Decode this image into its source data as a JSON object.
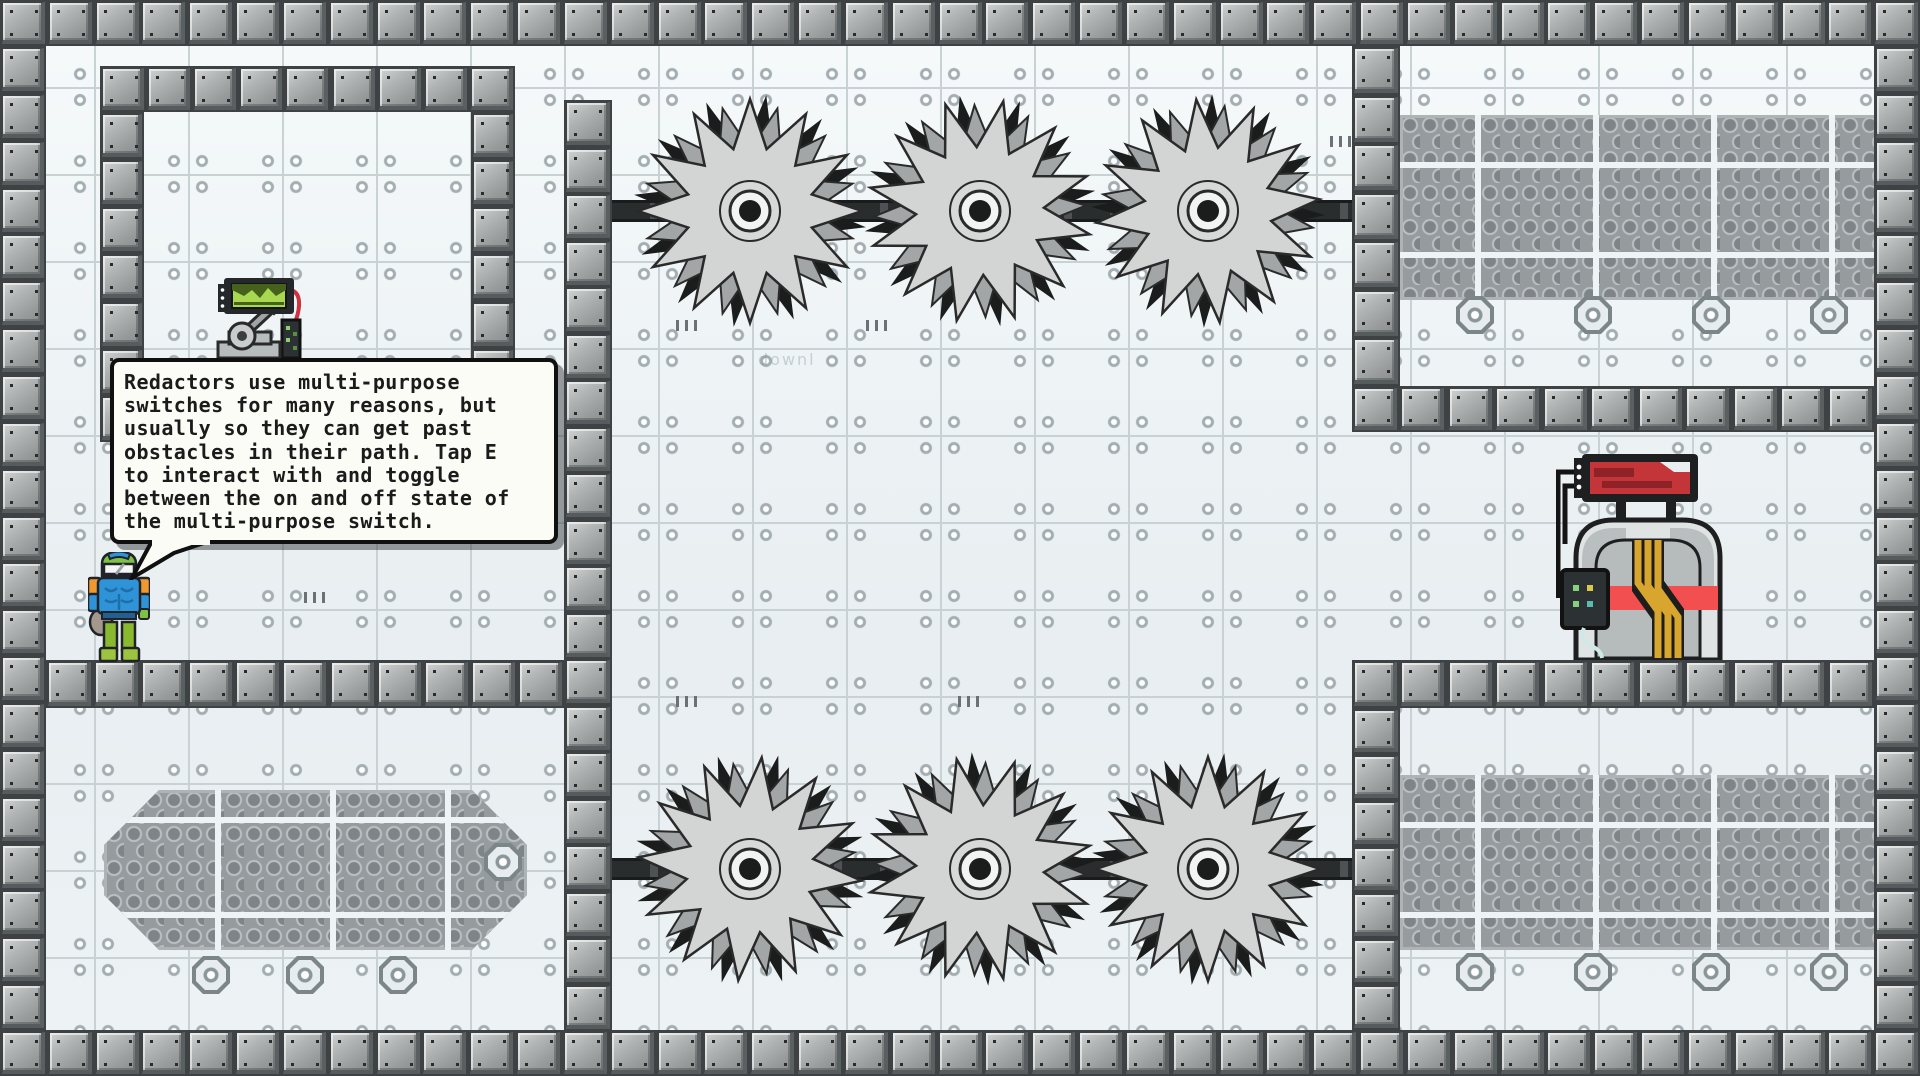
{
  "bubble": {
    "text": "Redactors use multi-purpose\nswitches for many reasons, but\nusually so they can get past\nobstacles in their path. Tap E\nto interact with and toggle\nbetween the on and off state of\nthe multi-purpose switch.",
    "interact_key": "E"
  },
  "watermark_text": "downl",
  "entities": {
    "player": "redactor-robot",
    "switch": "multi-purpose-switch",
    "machine": "wired-console",
    "hazard": "spinning-saw-blade",
    "saw_count": 6
  },
  "colors": {
    "tile": "#edf2f4",
    "tile_line": "#c8d2d5",
    "block": "#a9adad",
    "block_gap": "#3f4244",
    "hex_bg": "#969b9e",
    "saw_light": "#d2d5d4",
    "saw_mid": "#a2a6a6",
    "saw_dark": "#1b1d1d",
    "bubble_bg": "#fcfcf6",
    "bubble_border": "#101010",
    "accent_red": "#e8474b",
    "accent_yellow": "#d8a52e",
    "accent_green": "#a8d84f",
    "player_blue": "#2f93d8",
    "player_green": "#7dc242",
    "player_orange": "#f0992e"
  },
  "level": {
    "walls": [
      {
        "x": 0,
        "y": 0,
        "w": 1920,
        "h": 46
      },
      {
        "x": 0,
        "y": 1030,
        "w": 1920,
        "h": 46
      },
      {
        "x": 0,
        "y": 46,
        "w": 46,
        "h": 984
      },
      {
        "x": 1874,
        "y": 46,
        "w": 46,
        "h": 984
      },
      {
        "x": 100,
        "y": 66,
        "w": 415,
        "h": 46
      },
      {
        "x": 100,
        "y": 112,
        "w": 44,
        "h": 330
      },
      {
        "x": 471,
        "y": 112,
        "w": 44,
        "h": 330
      },
      {
        "x": 564,
        "y": 100,
        "w": 48,
        "h": 930
      },
      {
        "x": 46,
        "y": 660,
        "w": 518,
        "h": 48
      },
      {
        "x": 1352,
        "y": 46,
        "w": 48,
        "h": 340
      },
      {
        "x": 1352,
        "y": 386,
        "w": 522,
        "h": 46
      },
      {
        "x": 1352,
        "y": 660,
        "w": 522,
        "h": 48
      },
      {
        "x": 1352,
        "y": 708,
        "w": 48,
        "h": 322
      }
    ],
    "rails": [
      {
        "x": 612,
        "y": 200,
        "w": 740,
        "h": 22
      },
      {
        "x": 612,
        "y": 858,
        "w": 740,
        "h": 22
      }
    ],
    "saws": [
      {
        "cx": 750,
        "cy": 211,
        "rot": 0
      },
      {
        "cx": 980,
        "cy": 211,
        "rot": 12
      },
      {
        "cx": 1208,
        "cy": 211,
        "rot": 24
      },
      {
        "cx": 750,
        "cy": 869,
        "rot": 6
      },
      {
        "cx": 980,
        "cy": 869,
        "rot": 18
      },
      {
        "cx": 1208,
        "cy": 869,
        "rot": 30
      }
    ],
    "saw_radius": 112,
    "hex_panels": [
      {
        "x": 1400,
        "y": 115,
        "w": 520,
        "h": 185,
        "v": [
          75,
          193,
          311,
          429
        ],
        "hl": [
          47,
          137
        ],
        "oct": false
      },
      {
        "x": 1400,
        "y": 775,
        "w": 520,
        "h": 175,
        "v": [
          75,
          193,
          311,
          429
        ],
        "hl": [
          47,
          137
        ],
        "oct": false
      },
      {
        "x": 104,
        "y": 790,
        "w": 423,
        "h": 160,
        "v": [
          111,
          226,
          341
        ],
        "hl": [
          27,
          122
        ],
        "oct": true
      }
    ],
    "octagon_bolts": [
      {
        "x": 211,
        "y": 975
      },
      {
        "x": 305,
        "y": 975
      },
      {
        "x": 398,
        "y": 975
      },
      {
        "x": 503,
        "y": 862
      },
      {
        "x": 1475,
        "y": 315
      },
      {
        "x": 1593,
        "y": 315
      },
      {
        "x": 1711,
        "y": 315
      },
      {
        "x": 1829,
        "y": 315
      },
      {
        "x": 1475,
        "y": 972
      },
      {
        "x": 1593,
        "y": 972
      },
      {
        "x": 1711,
        "y": 972
      },
      {
        "x": 1829,
        "y": 972
      }
    ],
    "ticks": [
      {
        "x": 676,
        "y": 320
      },
      {
        "x": 866,
        "y": 320
      },
      {
        "x": 1330,
        "y": 136
      },
      {
        "x": 676,
        "y": 696
      },
      {
        "x": 958,
        "y": 696
      },
      {
        "x": 304,
        "y": 592
      }
    ]
  }
}
